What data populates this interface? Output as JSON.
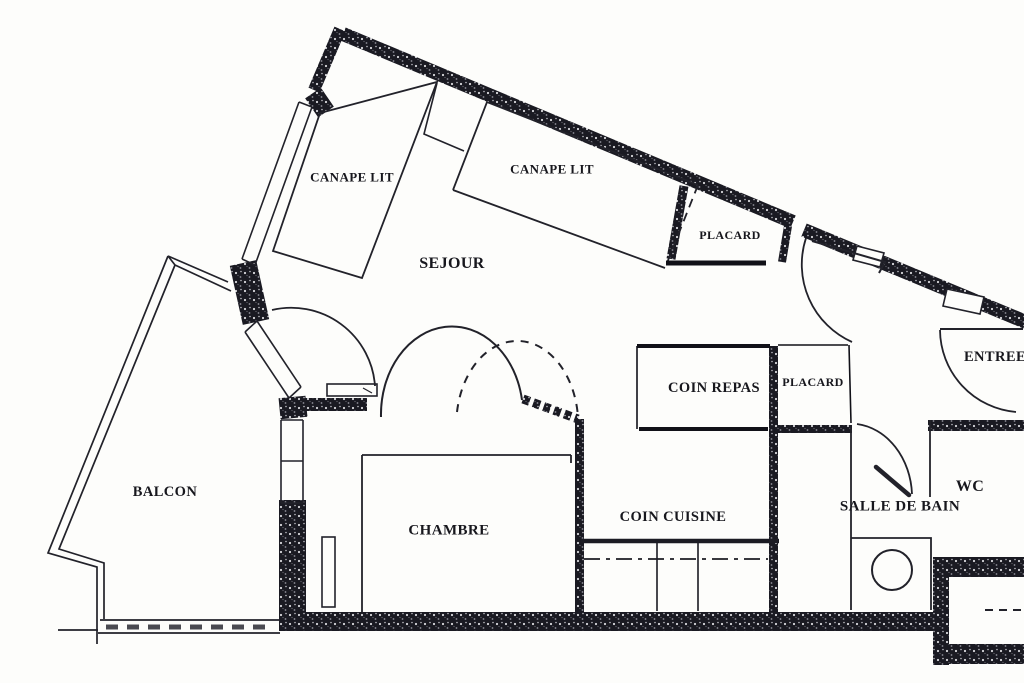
{
  "labels": {
    "canape_lit_1": "CANAPE LIT",
    "canape_lit_2": "CANAPE LIT",
    "sejour": "SEJOUR",
    "placard_entree": "PLACARD",
    "coin_repas": "COIN REPAS",
    "placard_cuisine": "PLACARD",
    "entree": "ENTREE",
    "balcon": "BALCON",
    "chambre": "CHAMBRE",
    "coin_cuisine": "COIN CUISINE",
    "salle_de_bain": "SALLE DE BAIN",
    "wc": "WC"
  },
  "colors": {
    "paper": "#fdfdfb",
    "ink": "#17171d",
    "wall": "#181820"
  }
}
